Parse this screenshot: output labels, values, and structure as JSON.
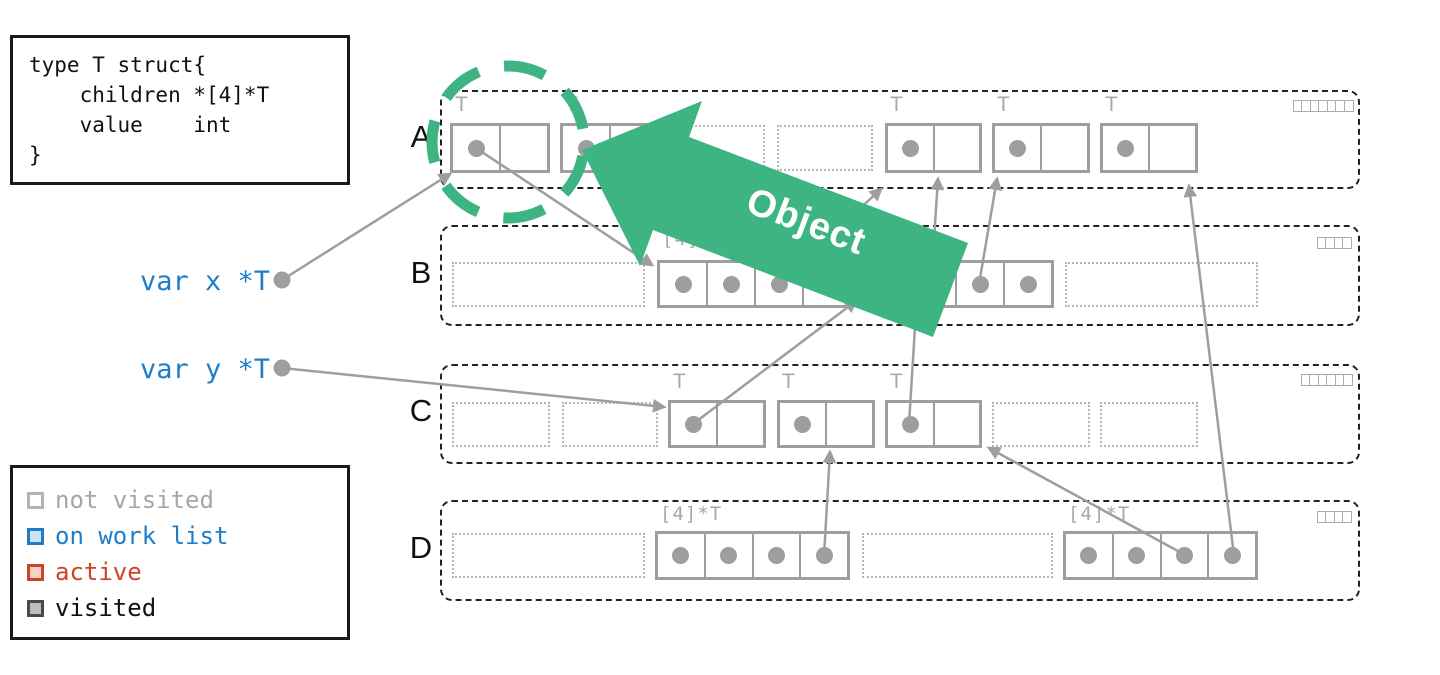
{
  "colors": {
    "green": "#3db482",
    "line_gray": "#9e9e9e",
    "label_gray": "#a8a8a8",
    "blue": "#1e7dc8",
    "red": "#d04228"
  },
  "code_box": {
    "lines": [
      "type T struct{",
      "    children *[4]*T",
      "    value    int",
      "}"
    ]
  },
  "variables": [
    {
      "label": "var x *T",
      "top": 266
    },
    {
      "label": "var y *T",
      "top": 354
    }
  ],
  "legend": {
    "items": [
      {
        "label": "not visited",
        "text_color": "#a6a6a6",
        "border_color": "#b3b3b3",
        "fill_color": "#ffffff"
      },
      {
        "label": "on work list",
        "text_color": "#1e7dc8",
        "border_color": "#1e7dc8",
        "fill_color": "#cfe3f3"
      },
      {
        "label": "active",
        "text_color": "#d04228",
        "border_color": "#d04228",
        "fill_color": "#f6d2c9"
      },
      {
        "label": "visited",
        "text_color": "#111111",
        "border_color": "#4a4a4a",
        "fill_color": "#bdbdbd"
      }
    ]
  },
  "object_arrow": {
    "label": "Object"
  },
  "rows": [
    {
      "label": "A",
      "y": 90,
      "h": 95,
      "box_top": 123,
      "box_h": 50,
      "slot_top": 125,
      "slot_h": 46,
      "tlabel_top": 93,
      "grid_top": 100,
      "grid_squares": 7,
      "items": [
        {
          "type": "obj",
          "x": 450,
          "w": 100,
          "label": "T"
        },
        {
          "type": "obj",
          "x": 560,
          "w": 100,
          "label": "T"
        },
        {
          "type": "slot",
          "x": 675,
          "w": 90
        },
        {
          "type": "slot",
          "x": 777,
          "w": 96
        },
        {
          "type": "obj",
          "x": 885,
          "w": 97,
          "label": "T"
        },
        {
          "type": "obj",
          "x": 992,
          "w": 98,
          "label": "T"
        },
        {
          "type": "obj",
          "x": 1100,
          "w": 98,
          "label": "T"
        }
      ]
    },
    {
      "label": "B",
      "y": 225,
      "h": 97,
      "box_top": 260,
      "box_h": 48,
      "slot_top": 262,
      "slot_h": 45,
      "tlabel_top": 228,
      "grid_top": 237,
      "grid_squares": 4,
      "items": [
        {
          "type": "slot",
          "x": 452,
          "w": 193
        },
        {
          "type": "arr",
          "x": 657,
          "w": 196,
          "label": "[4]*T"
        },
        {
          "type": "arr",
          "x": 858,
          "w": 196,
          "label": "[4]*T"
        },
        {
          "type": "slot",
          "x": 1065,
          "w": 193
        }
      ]
    },
    {
      "label": "C",
      "y": 364,
      "h": 96,
      "box_top": 400,
      "box_h": 48,
      "slot_top": 402,
      "slot_h": 45,
      "tlabel_top": 370,
      "grid_top": 374,
      "grid_squares": 6,
      "items": [
        {
          "type": "slot",
          "x": 452,
          "w": 98
        },
        {
          "type": "slot",
          "x": 562,
          "w": 96
        },
        {
          "type": "obj",
          "x": 668,
          "w": 98,
          "label": "T"
        },
        {
          "type": "obj",
          "x": 777,
          "w": 98,
          "label": "T"
        },
        {
          "type": "obj",
          "x": 885,
          "w": 97,
          "label": "T"
        },
        {
          "type": "slot",
          "x": 992,
          "w": 98
        },
        {
          "type": "slot",
          "x": 1100,
          "w": 98
        }
      ]
    },
    {
      "label": "D",
      "y": 500,
      "h": 97,
      "box_top": 531,
      "box_h": 49,
      "slot_top": 533,
      "slot_h": 45,
      "tlabel_top": 503,
      "grid_top": 511,
      "grid_squares": 4,
      "items": [
        {
          "type": "slot",
          "x": 452,
          "w": 193
        },
        {
          "type": "arr",
          "x": 655,
          "w": 195,
          "label": "[4]*T"
        },
        {
          "type": "slot",
          "x": 862,
          "w": 191
        },
        {
          "type": "arr",
          "x": 1063,
          "w": 195,
          "label": "[4]*T"
        }
      ]
    }
  ],
  "var_dots": [
    {
      "x": 282,
      "y": 280
    },
    {
      "x": 282,
      "y": 368
    }
  ],
  "pointers": [
    {
      "x1": 282,
      "y1": 280,
      "x2": 450,
      "y2": 174
    },
    {
      "x1": 476,
      "y1": 148,
      "x2": 652,
      "y2": 265
    },
    {
      "x1": 282,
      "y1": 368,
      "x2": 664,
      "y2": 407
    },
    {
      "x1": 693,
      "y1": 424,
      "x2": 856,
      "y2": 301
    },
    {
      "x1": 909,
      "y1": 424,
      "x2": 916,
      "y2": 311
    },
    {
      "x1": 778,
      "y1": 284,
      "x2": 881,
      "y2": 189
    },
    {
      "x1": 931,
      "y1": 284,
      "x2": 938,
      "y2": 179
    },
    {
      "x1": 979,
      "y1": 284,
      "x2": 997,
      "y2": 179
    },
    {
      "x1": 824,
      "y1": 556,
      "x2": 830,
      "y2": 452
    },
    {
      "x1": 1187,
      "y1": 556,
      "x2": 989,
      "y2": 448
    },
    {
      "x1": 1234,
      "y1": 556,
      "x2": 1189,
      "y2": 186
    }
  ],
  "circle": {
    "cx": 508,
    "cy": 142,
    "r": 76,
    "stroke_width": 11,
    "dash": "42 26",
    "dashoffset": -14
  },
  "arrow_polygon": "582,150 702,101 689,137 968,243 933,337 653,230 640,266",
  "object_label_transform": "translate(802,233) rotate(20.8)"
}
